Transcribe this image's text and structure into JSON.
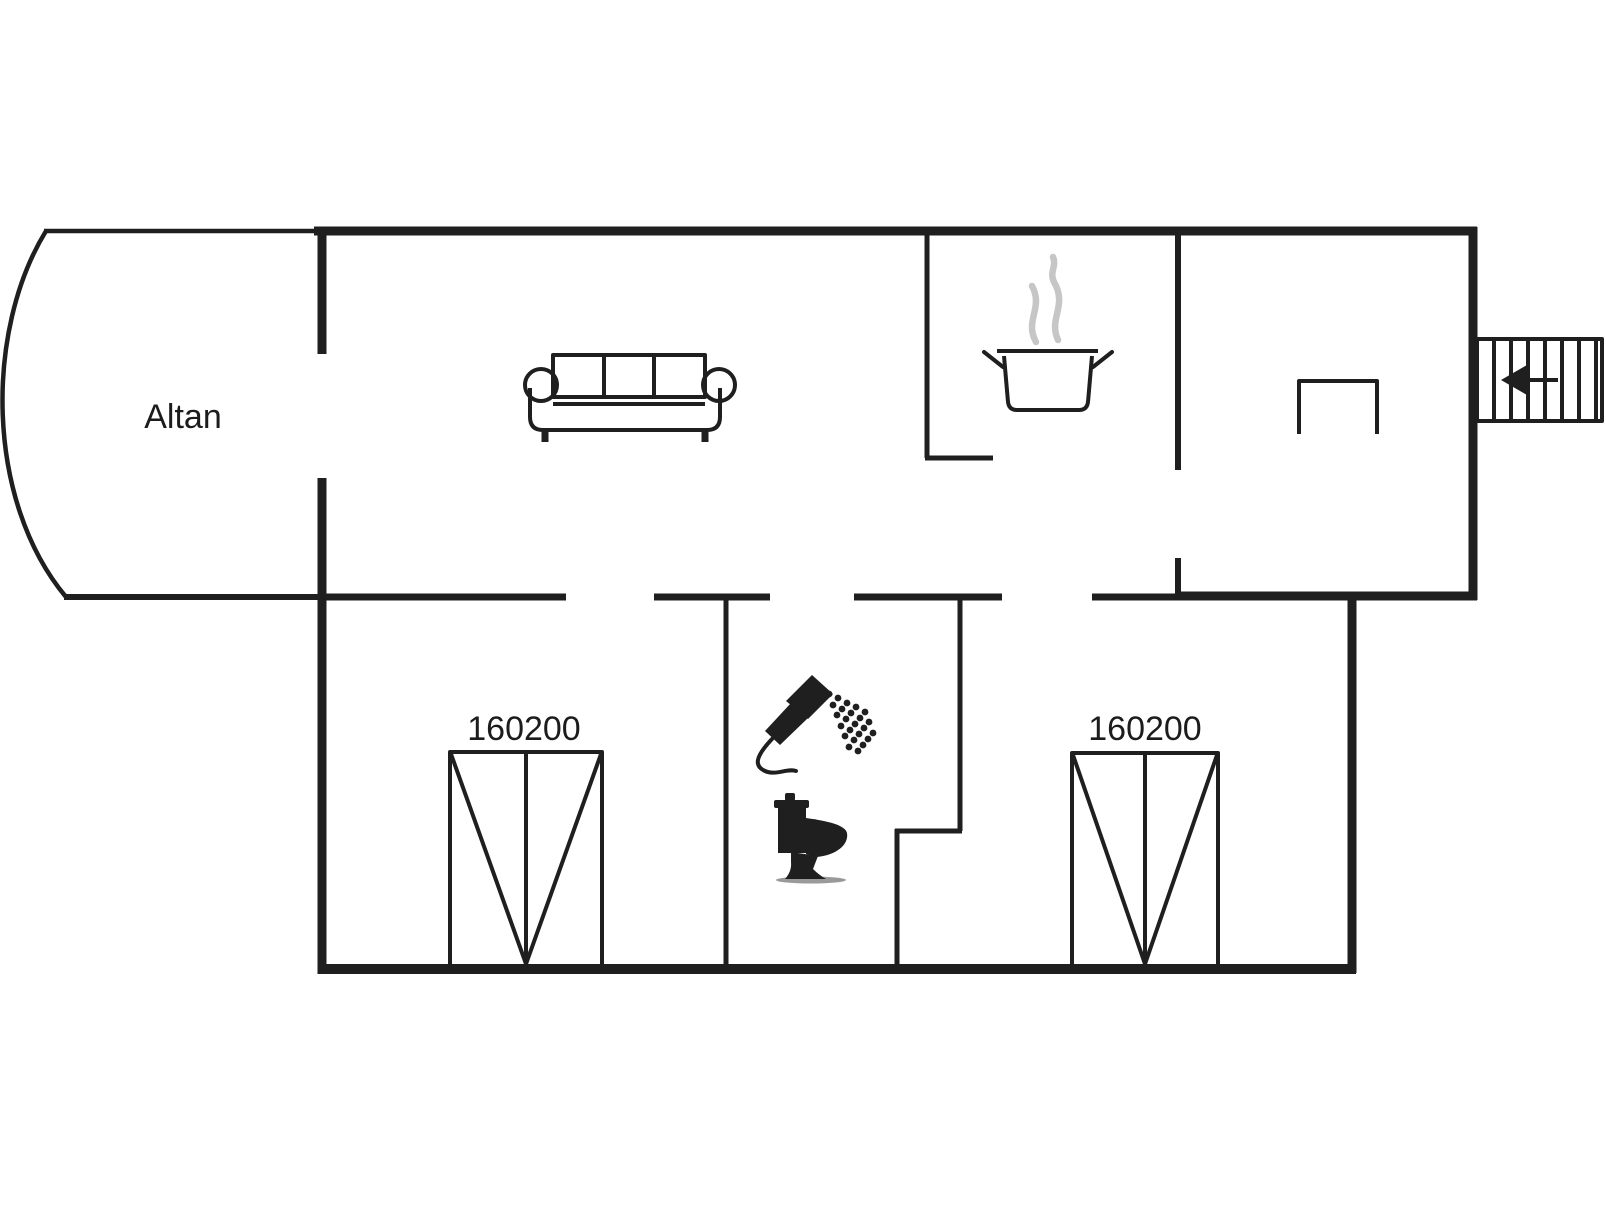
{
  "document": {
    "type": "floor-plan",
    "background": "#ffffff"
  },
  "colors": {
    "wall": "#1f1f1f",
    "steam": "#c6c6c6",
    "text": "#1c1c1c"
  },
  "labels": {
    "balcony": "Altan",
    "bed_left_size": "160200",
    "bed_right_size": "160200"
  },
  "icons": [
    {
      "name": "sofa-icon",
      "meaning": "three-seat sofa in living room"
    },
    {
      "name": "cooking-pot-icon",
      "meaning": "pot with steam in kitchen"
    },
    {
      "name": "steam-icon",
      "meaning": "steam wisps above pot"
    },
    {
      "name": "table-icon",
      "meaning": "table in right room"
    },
    {
      "name": "stairs-icon",
      "meaning": "external staircase"
    },
    {
      "name": "stairs-arrow-icon",
      "meaning": "arrow pointing left into house"
    },
    {
      "name": "double-bed-left-icon",
      "meaning": "double bed 160x200 cm"
    },
    {
      "name": "double-bed-right-icon",
      "meaning": "double bed 160x200 cm"
    },
    {
      "name": "shower-icon",
      "meaning": "hand shower with spray"
    },
    {
      "name": "toilet-icon",
      "meaning": "toilet side view"
    }
  ]
}
